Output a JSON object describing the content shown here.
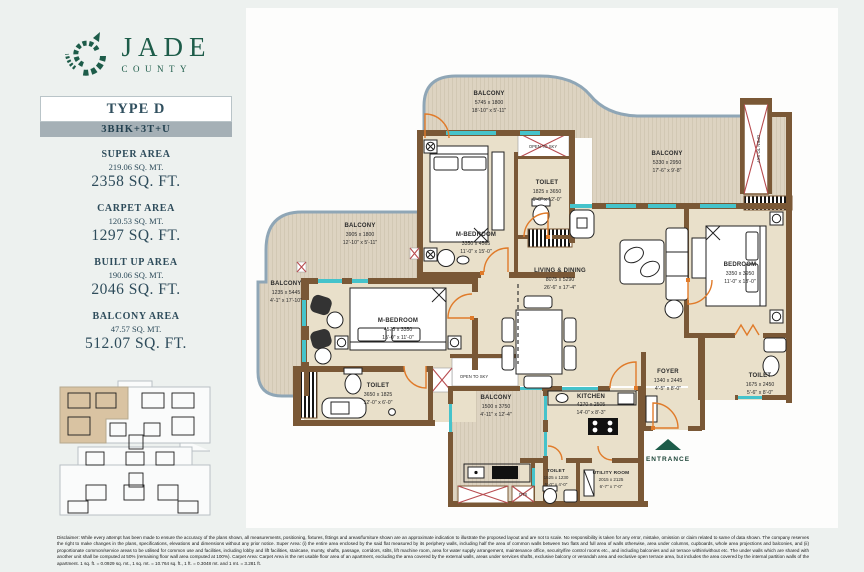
{
  "brand": {
    "name": "JADE",
    "subname": "COUNTY"
  },
  "palette": {
    "brand_green": "#1d5c49",
    "text_slate": "#2e4c5b",
    "wall_brown": "#7a5836",
    "door_orange": "#e07b2a",
    "window_teal": "#45c3cb",
    "balcony_edge": "#8fa6b6",
    "open_sky_red": "#b84c50",
    "highlight_tan": "#d9c3a2"
  },
  "unit": {
    "type_label": "TYPE D",
    "config": "3BHK+3T+U"
  },
  "areas": [
    {
      "label": "SUPER AREA",
      "metric": "219.06 SQ. MT.",
      "imperial": "2358 SQ. FT."
    },
    {
      "label": "CARPET AREA",
      "metric": "120.53 SQ. MT.",
      "imperial": "1297 SQ. FT."
    },
    {
      "label": "BUILT UP AREA",
      "metric": "190.06 SQ. MT.",
      "imperial": "2046 SQ. FT."
    },
    {
      "label": "BALCONY AREA",
      "metric": "47.57 SQ. MT.",
      "imperial": "512.07 SQ. FT."
    }
  ],
  "floorplan": {
    "rooms": [
      {
        "name": "BALCONY",
        "metric": "5745 x 1800",
        "imperial": "18'-10\" x 5'-11\""
      },
      {
        "name": "BALCONY",
        "metric": "5330 x 2950",
        "imperial": "17'-6\" x 9'-8\""
      },
      {
        "name": "BALCONY",
        "metric": "3905 x 1800",
        "imperial": "12'-10\" x 5'-11\""
      },
      {
        "name": "BALCONY",
        "metric": "1235 x 5445",
        "imperial": "4'-1\" x 17'-10\""
      },
      {
        "name": "M-BEDROOM",
        "metric": "3350 x 4565",
        "imperial": "11'-0\" x 15'-0\""
      },
      {
        "name": "TOILET",
        "metric": "1825 x 3650",
        "imperial": "6'-0\" x 12'-0\""
      },
      {
        "name": "LIVING & DINING",
        "metric": "8075 x 5290",
        "imperial": "26'-6\" x 17'-4\""
      },
      {
        "name": "BEDROOM",
        "metric": "3350 x 3950",
        "imperial": "11'-0\" x 13'-0\""
      },
      {
        "name": "M-BEDROOM",
        "metric": "4575 x 3350",
        "imperial": "15'-0\" x 11'-0\""
      },
      {
        "name": "TOILET",
        "metric": "3650 x 1825",
        "imperial": "12'-0\" x 6'-0\""
      },
      {
        "name": "BALCONY",
        "metric": "1500 x 3750",
        "imperial": "4'-11\" x 12'-4\""
      },
      {
        "name": "KITCHEN",
        "metric": "4270 x 2505",
        "imperial": "14'-0\" x 8'-3\""
      },
      {
        "name": "FOYER",
        "metric": "1340 x 2445",
        "imperial": "4'-5\" x 8'-0\""
      },
      {
        "name": "TOILET",
        "metric": "1675 x 2450",
        "imperial": "5'-6\" x 8'-0\""
      },
      {
        "name": "TOILET",
        "metric": "1525 x 1230",
        "imperial": "5'-0\" x 4'-0\""
      },
      {
        "name": "UTILITY ROOM",
        "metric": "2015 x 2125",
        "imperial": "6'-7\" x 7'-0\""
      }
    ],
    "labels": {
      "entrance": "ENTRANCE",
      "open_to_sky": "OPEN TO SKY",
      "ots": "OTS"
    }
  },
  "disclaimer": "Disclaimer: While every attempt has been made to ensure the accuracy of the plans shown, all measurements, positioning, fixtures, fittings and areas/furniture shown are an approximate indication to illustrate the proposed layout and are not to scale. No responsibility is taken for any error, mistake, omission or claim related to same of data shown. The company reserves the right to make changes in the plans, specifications, elevations and dimensions without any prior notice. Super Area: (i) the entire area enclosed by the said flat measured by its periphery walls, including half the area of common walls between two flats and full area of walls otherwise, area under columns, cupboards, whole area projections and balconies, and (ii) proportionate common/service areas to be utilised for common use and facilities, including lobby and lift facilities, staircase, mumty, shafts, passage, corridors, stilts, lift machine room, area for water supply arrangement, maintenance office, security/fire control rooms etc., and including balconies and air terrace within/without etc. The under walls which are shared with another unit shall be computed at 50% (remaining floor wall area computed at 100%). Carpet Area: Carpet Area is the net usable floor area of an apartment, excluding the area covered by the external walls, areas under services shafts, exclusive balcony or verandah area and exclusive open terrace area, but includes the area covered by the internal partition walls of the apartment. 1 sq. ft. = 0.0929 sq. mt., 1 sq. mt. = 10.764 sq. ft., 1 ft. = 0.3048 mt. and 1 mt. = 3.281 ft."
}
